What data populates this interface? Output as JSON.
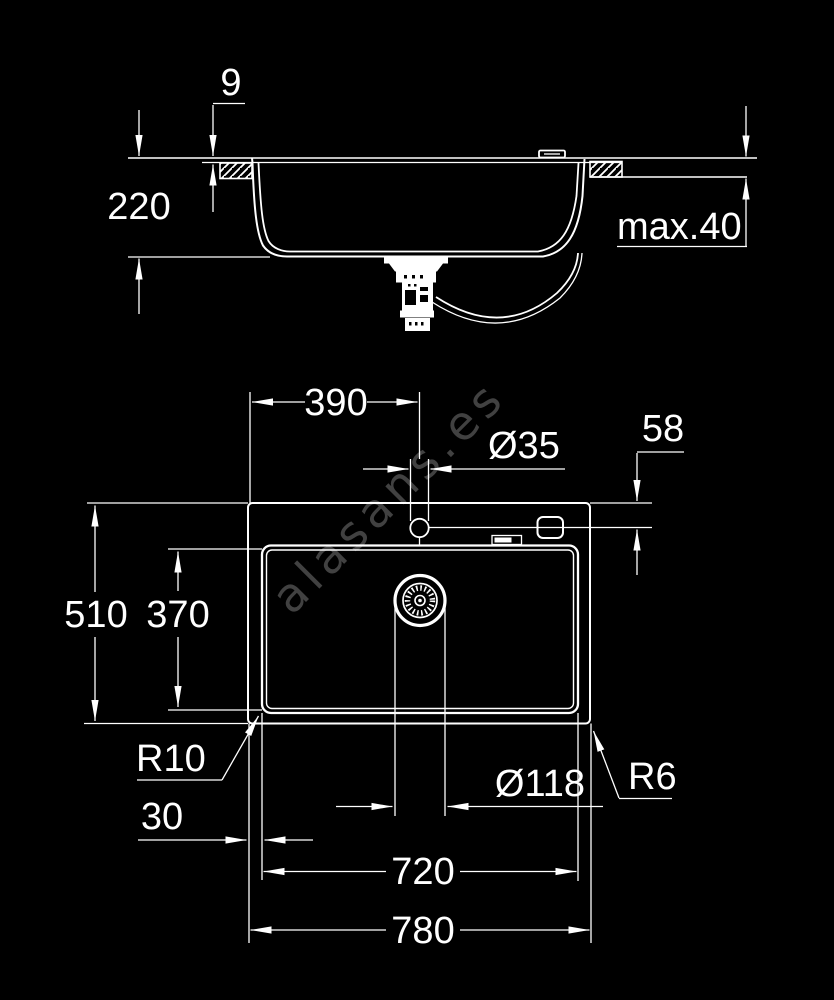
{
  "colors": {
    "background": "#000000",
    "line": "#ffffff",
    "text": "#ffffff",
    "watermark": "#414141"
  },
  "watermark": {
    "text": "alasans.es"
  },
  "side_view": {
    "dimensions": {
      "rim_above_worktop": "9",
      "overall_depth": "220",
      "worktop_thickness": "max.40"
    }
  },
  "plan_view": {
    "dimensions": {
      "tap_center_from_left": "390",
      "tap_hole_diameter": "Ø35",
      "tap_center_from_top": "58",
      "outer_depth": "510",
      "bowl_depth": "370",
      "bowl_corner_radius": "R10",
      "left_rim_width": "30",
      "drain_diameter": "Ø118",
      "outer_corner_radius": "R6",
      "bowl_width": "720",
      "overall_width": "780"
    }
  }
}
